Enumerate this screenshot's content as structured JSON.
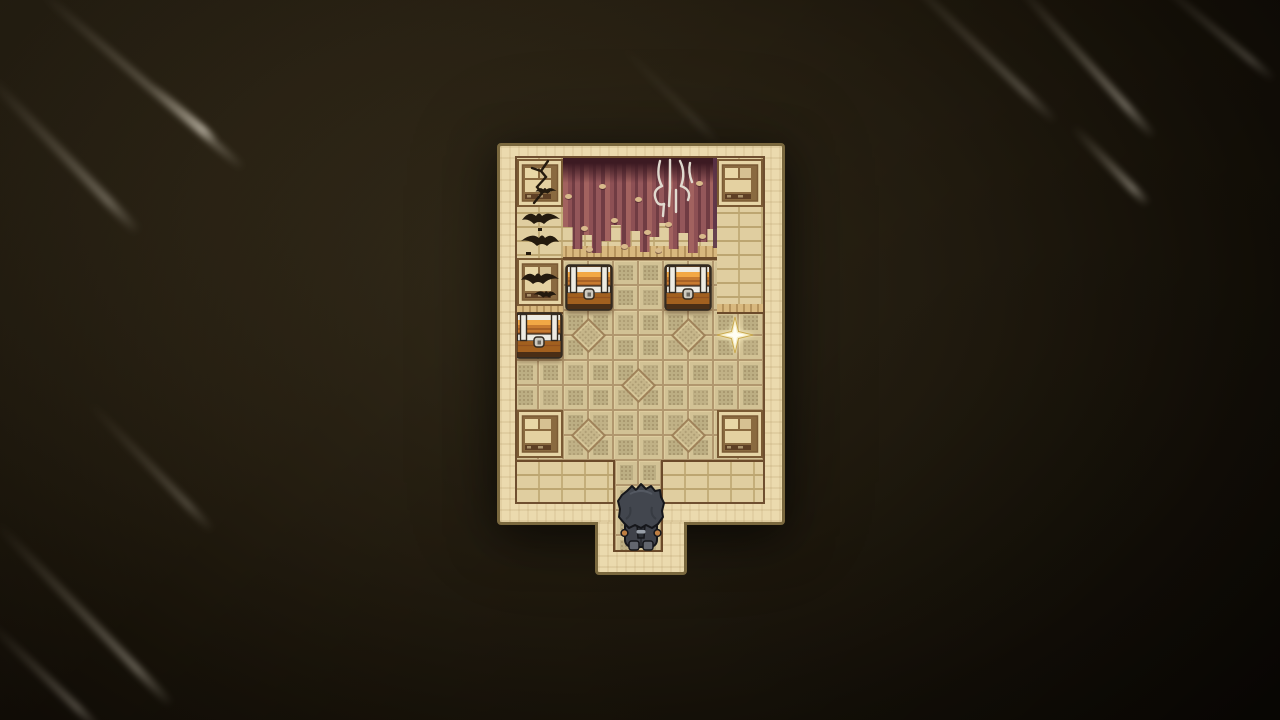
{
  "scene": {
    "name": "pixel-art dungeon room with treasure chests",
    "viewport": {
      "width": 1280,
      "height": 720
    },
    "background": {
      "center_color": "#332b1a",
      "mid_color": "#241d10",
      "edge_color": "#0d0905",
      "streaks": [
        {
          "x": 40,
          "y": -12,
          "len": 270,
          "angle": 41,
          "width": 7,
          "opacity": 0.5
        },
        {
          "x": -14,
          "y": 70,
          "len": 220,
          "angle": 46,
          "width": 9,
          "opacity": 0.38
        },
        {
          "x": 152,
          "y": 82,
          "len": 85,
          "angle": 41,
          "width": 6,
          "opacity": 0.8
        },
        {
          "x": 88,
          "y": 398,
          "len": 180,
          "angle": 46,
          "width": 7,
          "opacity": 0.28
        },
        {
          "x": -5,
          "y": 518,
          "len": 255,
          "angle": 46,
          "width": 8,
          "opacity": 0.42
        },
        {
          "x": -12,
          "y": 618,
          "len": 155,
          "angle": 44,
          "width": 7,
          "opacity": 0.35
        },
        {
          "x": 898,
          "y": -34,
          "len": 220,
          "angle": 44,
          "width": 7,
          "opacity": 0.32
        },
        {
          "x": 1014,
          "y": -22,
          "len": 210,
          "angle": 48,
          "width": 7,
          "opacity": 0.5
        },
        {
          "x": 1072,
          "y": 122,
          "len": 110,
          "angle": 46,
          "width": 7,
          "opacity": 0.52
        },
        {
          "x": 1152,
          "y": -26,
          "len": 160,
          "angle": 40,
          "width": 6,
          "opacity": 0.3
        },
        {
          "x": 620,
          "y": 42,
          "len": 140,
          "angle": 45,
          "width": 6,
          "opacity": 0.13
        }
      ]
    },
    "room": {
      "outer": {
        "x": 497,
        "y": 143,
        "w": 288,
        "h": 382
      },
      "band": {
        "top": 15,
        "left": 20,
        "right": 22,
        "bottom": 23
      },
      "protrusion": {
        "x": 595,
        "y": 522,
        "w": 92,
        "h": 53
      },
      "passage": {
        "x": 613,
        "y": 460,
        "w": 50,
        "h": 92
      },
      "grid": {
        "origin_x": 513,
        "origin_y": 260,
        "cell": 25,
        "cols": 10,
        "rows": 8
      },
      "diamond_tiles": [
        [
          588,
          335
        ],
        [
          688,
          335
        ],
        [
          638,
          385
        ],
        [
          588,
          435
        ],
        [
          688,
          435
        ]
      ],
      "backwall": {
        "x": 517,
        "y": 158,
        "w": 246,
        "h": 102
      },
      "mid_ledge": {
        "x": 560,
        "y": 246,
        "w": 160,
        "h": 14
      },
      "columns": [
        {
          "x": 517,
          "y": 158,
          "w": 46,
          "h": 146
        },
        {
          "x": 717,
          "y": 158,
          "w": 46,
          "h": 146
        }
      ],
      "column_ledges": [
        {
          "x": 517,
          "y": 304,
          "w": 46,
          "h": 10
        },
        {
          "x": 717,
          "y": 304,
          "w": 46,
          "h": 10
        }
      ],
      "curtain": {
        "x": 563,
        "y": 157,
        "w": 154,
        "h": 96,
        "fringe": [
          70,
          92,
          78,
          96,
          84,
          68,
          90,
          74,
          95,
          80,
          66,
          92,
          76,
          96,
          85,
          72
        ],
        "spots": [
          [
            568,
            196
          ],
          [
            584,
            228
          ],
          [
            602,
            186
          ],
          [
            614,
            220
          ],
          [
            638,
            199
          ],
          [
            647,
            232
          ],
          [
            589,
            249
          ],
          [
            668,
            224
          ],
          [
            699,
            183
          ],
          [
            658,
            250
          ],
          [
            624,
            246
          ],
          [
            702,
            236
          ]
        ]
      },
      "curtain_sliver": {
        "x": 713,
        "y": 158,
        "w": 5,
        "h": 90
      },
      "bottom_bricks": [
        {
          "x": 517,
          "y": 460,
          "w": 96,
          "h": 42
        },
        {
          "x": 663,
          "y": 460,
          "w": 100,
          "h": 42
        }
      ]
    },
    "entities": {
      "crate_tiles": [
        {
          "variant": "cracked",
          "x": 517,
          "y": 159
        },
        {
          "variant": "plain",
          "x": 717,
          "y": 159
        },
        {
          "variant": "bat",
          "x": 517,
          "y": 258
        },
        {
          "variant": "plain",
          "x": 517,
          "y": 410
        },
        {
          "variant": "plain",
          "x": 717,
          "y": 410
        }
      ],
      "bat_swarm": {
        "x": 518,
        "y": 204,
        "w": 45,
        "h": 56
      },
      "candelabra": {
        "x": 648,
        "y": 158,
        "w": 54,
        "h": 64
      },
      "chests": [
        {
          "x": 565,
          "y": 264
        },
        {
          "x": 664,
          "y": 264
        },
        {
          "x": 515,
          "y": 312
        }
      ],
      "chest_size": {
        "w": 48,
        "h": 47
      },
      "sparkle": {
        "x": 735,
        "y": 335,
        "size": 40
      },
      "player": {
        "x": 616,
        "y": 481,
        "w": 50,
        "h": 72,
        "facing": "up"
      }
    },
    "palette": {
      "wall_cream": "#ebdaae",
      "wall_mottle": "#d9c69a",
      "wall_border": "#7a683e",
      "inner_line": "#6f4f30",
      "brick": "#e0cea0",
      "brick_mortar": "#bda671",
      "brick_dark": "#8a6a46",
      "ledge": "#d8b87e",
      "ledge_slat": "#ab8852",
      "ledge_line": "#6b4a2a",
      "floor": "#d2c295",
      "floor_inset": "#b9ab80",
      "floor_line": "#8f6c48",
      "floor_hi": "#e7d7a7",
      "curtain_a": "#a2625f",
      "curtain_b": "#8d5054",
      "curtain_c": "#703c43",
      "curtain_d": "#94575a",
      "curtain_top": "#3c1a22",
      "curtain_spot": "#d9ba8b",
      "crate_frame": "#e6d5a6",
      "crate_dark": "#7a5a34",
      "crate_fill": "#8a6a40",
      "crate_block": "#e9d7a6",
      "bat": "#241a0e",
      "chest_wood": "#c87b30",
      "chest_wood_hi": "#f2a845",
      "chest_wood_low": "#a2601f",
      "chest_plank": "#8a4a1e",
      "chest_metal": "#eeebe2",
      "chest_metal2": "#cdc9bf",
      "chest_outline": "#332a20",
      "chest_base": "#4a2e16",
      "sparkle_fill": "#f6eec6",
      "sparkle_core": "#fffdf2",
      "sparkle_edge": "#c9a84e",
      "hair": "#42464e",
      "hair_hi": "#5d636c",
      "hair_dark": "#2c2f35",
      "outline": "#15161a",
      "coat": "#3f424a",
      "boot": "#62666e",
      "hand": "#bf7f42",
      "tie": "#99a0a9",
      "streak": "#cfc6b4"
    }
  }
}
